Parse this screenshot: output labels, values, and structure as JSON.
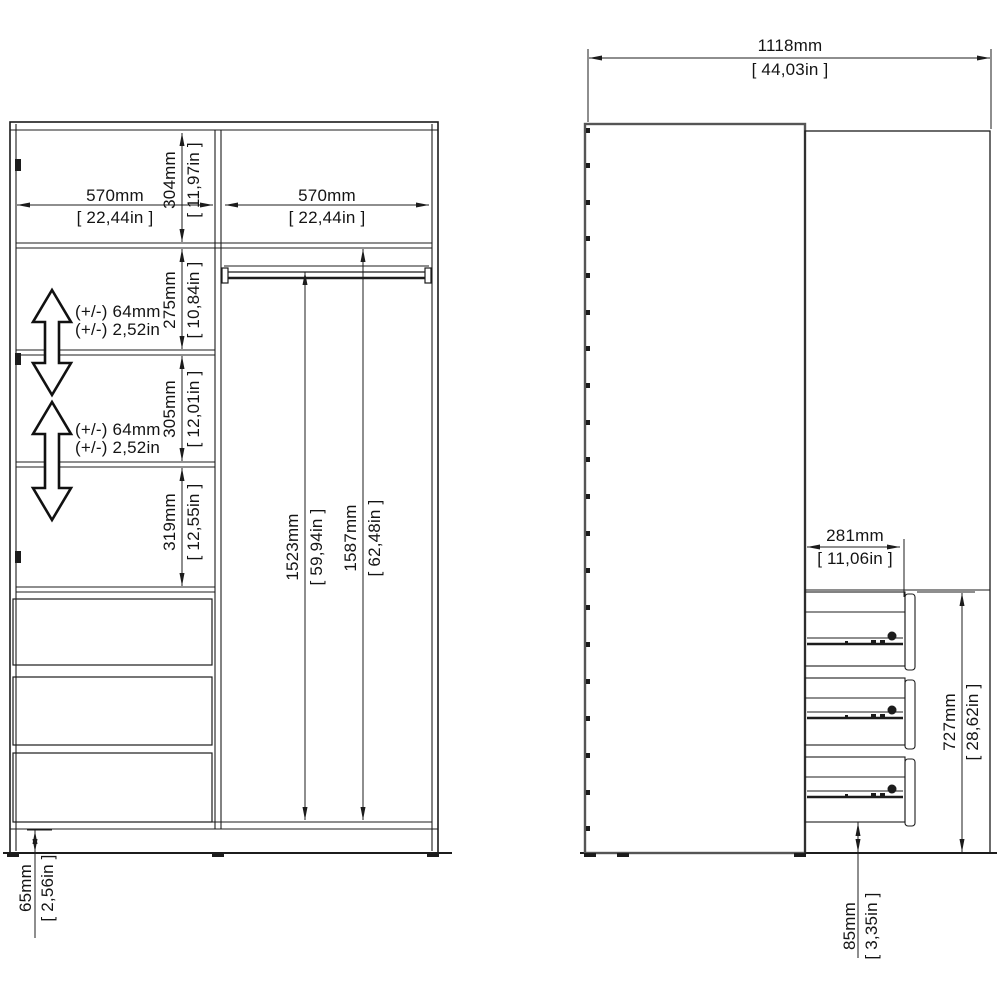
{
  "drawing": {
    "title": "wardrobe-dimension-diagram",
    "colors": {
      "line": "#1c1c1c",
      "door_line": "#555555",
      "background": "#ffffff"
    },
    "front_view": {
      "left_width": {
        "mm": "570mm",
        "in": "[ 22,44in ]"
      },
      "right_width": {
        "mm": "570mm",
        "in": "[ 22,44in ]"
      },
      "top_section": {
        "mm": "304mm",
        "in": "[ 11,97in ]"
      },
      "gap1": {
        "mm": "275mm",
        "in": "[ 10,84in ]"
      },
      "gap2": {
        "mm": "305mm",
        "in": "[ 12,01in ]"
      },
      "gap3": {
        "mm": "319mm",
        "in": "[ 12,55in ]"
      },
      "adjust1": {
        "line1": "(+/-) 64mm",
        "line2": "(+/-) 2,52in"
      },
      "adjust2": {
        "line1": "(+/-) 64mm",
        "line2": "(+/-) 2,52in"
      },
      "rail_height": {
        "mm": "1523mm",
        "in": "[ 59,94in ]"
      },
      "interior_height": {
        "mm": "1587mm",
        "in": "[ 62,48in ]"
      },
      "plinth": {
        "mm": "65mm",
        "in": "[ 2,56in ]"
      }
    },
    "side_view": {
      "total_width": {
        "mm": "1118mm",
        "in": "[ 44,03in ]"
      },
      "drawer_depth": {
        "mm": "281mm",
        "in": "[ 11,06in ]"
      },
      "drawer_section": {
        "mm": "727mm",
        "in": "[ 28,62in ]"
      },
      "base_height": {
        "mm": "85mm",
        "in": "[ 3,35in ]"
      }
    }
  }
}
